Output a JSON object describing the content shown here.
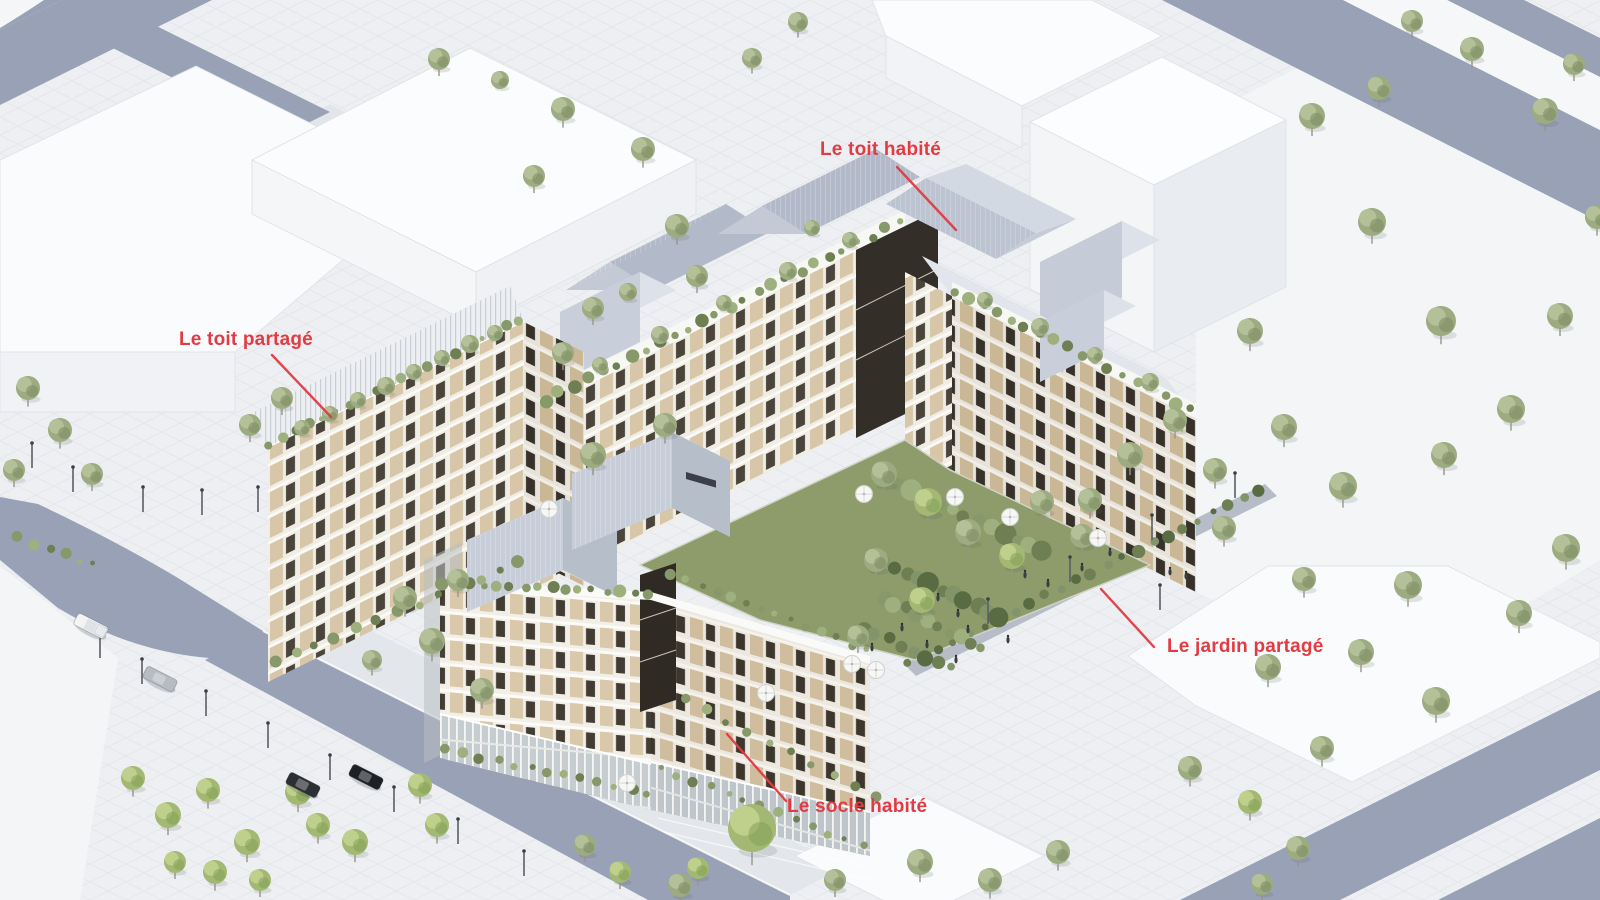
{
  "annotations": {
    "color": "#e23b43",
    "font_size_px": 19,
    "labels": [
      {
        "id": "toit-habite",
        "text": "Le toit habité",
        "x": 820,
        "y": 139,
        "leader": [
          897,
          167,
          956,
          230
        ]
      },
      {
        "id": "toit-partage",
        "text": "Le toit partagé",
        "x": 179,
        "y": 329,
        "leader": [
          272,
          355,
          331,
          417
        ]
      },
      {
        "id": "jardin-partage",
        "text": "Le jardin partagé",
        "x": 1167,
        "y": 636,
        "leader": [
          1154,
          647,
          1101,
          589
        ]
      },
      {
        "id": "socle-habite",
        "text": "Le socle habité",
        "x": 787,
        "y": 796,
        "leader": [
          786,
          801,
          727,
          734
        ]
      }
    ]
  },
  "scene": {
    "palette": {
      "background": "#edeff2",
      "plaza": "#f3f5f7",
      "road": "#98a1b6",
      "path": "#b6bdc8",
      "context_white": "#fafbfd",
      "facade_white": "#f0ede5",
      "facade_beige": "#d7c6a7",
      "window_dark": "#4a443a",
      "roof_metal_light": "#cfd6e0",
      "roof_metal_dark": "#b2bac9",
      "garden_green": "#8d9c6a",
      "tree_sage": "#9cab80",
      "tree_bright": "#a3b873",
      "label_red": "#e23b43"
    },
    "trees": [
      [
        1312,
        116,
        13,
        "s"
      ],
      [
        1372,
        222,
        14,
        "s"
      ],
      [
        1441,
        321,
        15,
        "s"
      ],
      [
        1560,
        316,
        13,
        "s"
      ],
      [
        1511,
        409,
        14,
        "s"
      ],
      [
        1444,
        455,
        13,
        "s"
      ],
      [
        1566,
        548,
        14,
        "s"
      ],
      [
        1519,
        613,
        13,
        "s"
      ],
      [
        1408,
        585,
        14,
        "s"
      ],
      [
        1361,
        652,
        13,
        "s"
      ],
      [
        1436,
        701,
        14,
        "s"
      ],
      [
        1304,
        579,
        12,
        "s"
      ],
      [
        1268,
        667,
        13,
        "s"
      ],
      [
        1322,
        748,
        12,
        "s"
      ],
      [
        1250,
        331,
        13,
        "s"
      ],
      [
        1284,
        427,
        13,
        "s"
      ],
      [
        1343,
        486,
        14,
        "s"
      ],
      [
        1224,
        528,
        12,
        "s"
      ],
      [
        1379,
        88,
        12,
        "s"
      ],
      [
        1472,
        49,
        12,
        "s"
      ],
      [
        1545,
        111,
        13,
        "s"
      ],
      [
        1597,
        217,
        12,
        "s"
      ],
      [
        1412,
        21,
        11,
        "s"
      ],
      [
        1574,
        64,
        11,
        "s"
      ],
      [
        439,
        59,
        11,
        "s"
      ],
      [
        500,
        80,
        9,
        "s"
      ],
      [
        563,
        109,
        12,
        "s"
      ],
      [
        534,
        176,
        11,
        "s"
      ],
      [
        643,
        149,
        12,
        "s"
      ],
      [
        677,
        226,
        12,
        "s"
      ],
      [
        697,
        276,
        11,
        "s"
      ],
      [
        593,
        308,
        11,
        "s"
      ],
      [
        563,
        353,
        11,
        "s"
      ],
      [
        752,
        58,
        10,
        "s"
      ],
      [
        798,
        22,
        10,
        "s"
      ],
      [
        28,
        388,
        12,
        "s"
      ],
      [
        60,
        430,
        12,
        "s"
      ],
      [
        14,
        470,
        11,
        "s"
      ],
      [
        92,
        474,
        11,
        "s"
      ],
      [
        133,
        778,
        12,
        "b"
      ],
      [
        168,
        815,
        13,
        "b"
      ],
      [
        208,
        790,
        12,
        "b"
      ],
      [
        247,
        842,
        13,
        "b"
      ],
      [
        215,
        872,
        12,
        "b"
      ],
      [
        298,
        792,
        13,
        "b"
      ],
      [
        318,
        825,
        12,
        "b"
      ],
      [
        355,
        842,
        13,
        "b"
      ],
      [
        175,
        862,
        11,
        "b"
      ],
      [
        260,
        880,
        11,
        "b"
      ],
      [
        420,
        785,
        12,
        "b"
      ],
      [
        437,
        825,
        12,
        "b"
      ],
      [
        585,
        845,
        11,
        "s"
      ],
      [
        620,
        872,
        11,
        "b"
      ],
      [
        680,
        885,
        12,
        "s"
      ],
      [
        752,
        828,
        24,
        "b"
      ],
      [
        698,
        868,
        11,
        "b"
      ],
      [
        835,
        880,
        11,
        "s"
      ],
      [
        920,
        862,
        13,
        "s"
      ],
      [
        990,
        880,
        12,
        "s"
      ],
      [
        1058,
        852,
        12,
        "s"
      ],
      [
        1190,
        768,
        12,
        "s"
      ],
      [
        1250,
        802,
        12,
        "b"
      ],
      [
        1298,
        848,
        12,
        "s"
      ],
      [
        1262,
        884,
        11,
        "s"
      ],
      [
        884,
        474,
        13,
        "s"
      ],
      [
        928,
        502,
        14,
        "b"
      ],
      [
        968,
        532,
        13,
        "s"
      ],
      [
        1012,
        556,
        13,
        "b"
      ],
      [
        876,
        560,
        12,
        "s"
      ],
      [
        922,
        600,
        13,
        "b"
      ],
      [
        1042,
        502,
        12,
        "s"
      ],
      [
        1082,
        536,
        12,
        "s"
      ],
      [
        858,
        636,
        11,
        "s"
      ],
      [
        1130,
        455,
        13,
        "s"
      ],
      [
        1175,
        420,
        12,
        "s"
      ],
      [
        1215,
        470,
        12,
        "s"
      ],
      [
        1090,
        500,
        12,
        "s"
      ],
      [
        405,
        598,
        12,
        "s"
      ],
      [
        432,
        641,
        13,
        "s"
      ],
      [
        458,
        580,
        11,
        "s"
      ],
      [
        482,
        690,
        12,
        "s"
      ],
      [
        372,
        660,
        10,
        "s"
      ],
      [
        250,
        425,
        11,
        "s"
      ],
      [
        282,
        398,
        11,
        "s"
      ],
      [
        302,
        428,
        8,
        "s"
      ],
      [
        330,
        414,
        8,
        "s"
      ],
      [
        358,
        400,
        8,
        "s"
      ],
      [
        386,
        386,
        9,
        "s"
      ],
      [
        414,
        372,
        8,
        "s"
      ],
      [
        442,
        358,
        8,
        "s"
      ],
      [
        470,
        344,
        9,
        "s"
      ],
      [
        495,
        333,
        8,
        "s"
      ],
      [
        600,
        365,
        8,
        "s"
      ],
      [
        660,
        335,
        9,
        "s"
      ],
      [
        724,
        303,
        8,
        "s"
      ],
      [
        788,
        271,
        9,
        "s"
      ],
      [
        850,
        240,
        8,
        "s"
      ],
      [
        628,
        292,
        9,
        "s"
      ],
      [
        812,
        228,
        8,
        "s"
      ],
      [
        593,
        455,
        13,
        "s"
      ],
      [
        665,
        425,
        12,
        "s"
      ],
      [
        985,
        300,
        8,
        "s"
      ],
      [
        1040,
        327,
        9,
        "s"
      ],
      [
        1095,
        355,
        8,
        "s"
      ],
      [
        1150,
        382,
        9,
        "s"
      ]
    ],
    "shrub_rows": [
      [
        545,
        400,
        900,
        222,
        26,
        5,
        "g"
      ],
      [
        955,
        292,
        1192,
        410,
        18,
        5,
        "g"
      ],
      [
        270,
        444,
        520,
        320,
        20,
        4,
        "g"
      ],
      [
        442,
        583,
        648,
        593,
        16,
        5,
        "g"
      ],
      [
        672,
        574,
        866,
        650,
        14,
        4,
        "g"
      ],
      [
        908,
        664,
        1260,
        490,
        24,
        5,
        "d"
      ],
      [
        447,
        750,
        648,
        794,
        13,
        4,
        "g"
      ],
      [
        660,
        768,
        862,
        846,
        13,
        4,
        "g"
      ],
      [
        684,
        700,
        876,
        795,
        10,
        5,
        "g"
      ],
      [
        274,
        662,
        520,
        562,
        13,
        5,
        "g"
      ],
      [
        18,
        538,
        95,
        565,
        6,
        4,
        "g"
      ],
      [
        872,
        556,
        1000,
        618,
        12,
        8,
        "d"
      ],
      [
        884,
        598,
        982,
        648,
        10,
        7,
        "g"
      ],
      [
        900,
        484,
        1042,
        552,
        12,
        8,
        "g"
      ],
      [
        862,
        628,
        952,
        668,
        8,
        6,
        "d"
      ]
    ],
    "lamps": [
      [
        32,
        468
      ],
      [
        73,
        492
      ],
      [
        143,
        512
      ],
      [
        202,
        515
      ],
      [
        258,
        512
      ],
      [
        100,
        658
      ],
      [
        142,
        684
      ],
      [
        206,
        716
      ],
      [
        268,
        748
      ],
      [
        330,
        780
      ],
      [
        394,
        812
      ],
      [
        458,
        844
      ],
      [
        524,
        876
      ],
      [
        1235,
        498
      ],
      [
        1152,
        540
      ],
      [
        1070,
        582
      ],
      [
        988,
        624
      ],
      [
        1160,
        610
      ]
    ],
    "umbrellas": [
      [
        955,
        497
      ],
      [
        1010,
        517
      ],
      [
        1098,
        538
      ],
      [
        864,
        494
      ],
      [
        852,
        664
      ],
      [
        876,
        670
      ],
      [
        766,
        693
      ],
      [
        627,
        783
      ],
      [
        549,
        509
      ]
    ],
    "people": [
      [
        938,
        598
      ],
      [
        958,
        614
      ],
      [
        1048,
        584
      ],
      [
        1008,
        640
      ],
      [
        902,
        628
      ],
      [
        1082,
        568
      ],
      [
        1110,
        553
      ],
      [
        956,
        660
      ],
      [
        872,
        648
      ],
      [
        1170,
        572
      ],
      [
        1186,
        576
      ],
      [
        1025,
        575
      ],
      [
        968,
        630
      ],
      [
        927,
        645
      ]
    ],
    "cars": [
      {
        "x": 91,
        "y": 626,
        "angle": 27,
        "type": "pickup",
        "color": "#f4f4f2"
      },
      {
        "x": 160,
        "y": 679,
        "angle": 27,
        "type": "car",
        "color": "#b7bcc2"
      },
      {
        "x": 303,
        "y": 785,
        "angle": 27,
        "type": "car",
        "color": "#2c2f34"
      },
      {
        "x": 366,
        "y": 777,
        "angle": 27,
        "type": "car",
        "color": "#1d2024"
      }
    ]
  }
}
